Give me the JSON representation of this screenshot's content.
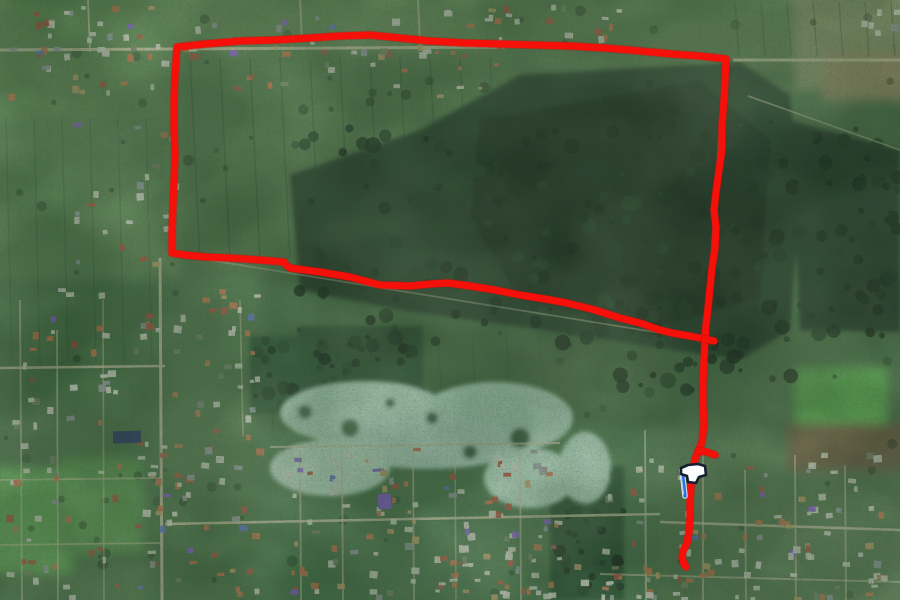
{
  "map": {
    "kind": "satellite-map-with-gps-track",
    "route": {
      "color": "#f5100a",
      "underlay_color": "#c00800",
      "stroke_width": 7,
      "loop": [
        [
          177,
          47
        ],
        [
          205,
          44
        ],
        [
          240,
          41
        ],
        [
          275,
          40
        ],
        [
          310,
          38
        ],
        [
          340,
          36
        ],
        [
          370,
          35
        ],
        [
          400,
          38
        ],
        [
          430,
          41
        ],
        [
          465,
          43
        ],
        [
          500,
          44
        ],
        [
          535,
          45
        ],
        [
          570,
          46
        ],
        [
          605,
          48
        ],
        [
          640,
          51
        ],
        [
          672,
          54
        ],
        [
          700,
          56
        ],
        [
          726,
          59
        ],
        [
          725,
          80
        ],
        [
          724,
          100
        ],
        [
          722,
          125
        ],
        [
          722,
          150
        ],
        [
          719,
          170
        ],
        [
          716,
          192
        ],
        [
          714,
          210
        ],
        [
          716,
          228
        ],
        [
          715,
          248
        ],
        [
          712,
          268
        ],
        [
          710,
          288
        ],
        [
          708,
          308
        ],
        [
          706,
          325
        ],
        [
          705,
          339
        ],
        [
          690,
          336
        ],
        [
          672,
          333
        ],
        [
          660,
          330
        ],
        [
          640,
          323
        ],
        [
          620,
          318
        ],
        [
          595,
          310
        ],
        [
          567,
          303
        ],
        [
          545,
          299
        ],
        [
          520,
          295
        ],
        [
          495,
          290
        ],
        [
          470,
          286
        ],
        [
          448,
          283
        ],
        [
          430,
          284
        ],
        [
          410,
          286
        ],
        [
          380,
          285
        ],
        [
          365,
          281
        ],
        [
          350,
          277
        ],
        [
          320,
          272
        ],
        [
          290,
          268
        ],
        [
          286,
          265
        ],
        [
          284,
          262
        ],
        [
          260,
          260
        ],
        [
          230,
          258
        ],
        [
          206,
          257
        ],
        [
          185,
          255
        ],
        [
          172,
          253
        ],
        [
          172,
          230
        ],
        [
          173,
          205
        ],
        [
          174,
          180
        ],
        [
          175,
          155
        ],
        [
          174,
          128
        ],
        [
          174,
          100
        ],
        [
          175,
          75
        ],
        [
          177,
          47
        ]
      ],
      "stem": [
        [
          705,
          339
        ],
        [
          704,
          360
        ],
        [
          703,
          382
        ],
        [
          703,
          405
        ],
        [
          704,
          425
        ],
        [
          702,
          442
        ],
        [
          699,
          450
        ],
        [
          695,
          459
        ],
        [
          693,
          470
        ],
        [
          691,
          486
        ],
        [
          690,
          502
        ],
        [
          690,
          518
        ],
        [
          689,
          532
        ],
        [
          687,
          543
        ],
        [
          683,
          551
        ],
        [
          682,
          558
        ],
        [
          684,
          564
        ],
        [
          686,
          567
        ]
      ],
      "branch": [
        [
          698,
          451
        ],
        [
          707,
          452
        ],
        [
          715,
          455
        ]
      ],
      "stub": [
        [
          705,
          339
        ],
        [
          714,
          341
        ]
      ]
    },
    "marker": {
      "name": "finish-flag",
      "x": 684,
      "y": 497,
      "flag_fill": "#fafcfe",
      "flag_outline": "#141e2e",
      "pole_color": "#2f6fe0",
      "pole_highlight": "#a9c2f2"
    }
  }
}
